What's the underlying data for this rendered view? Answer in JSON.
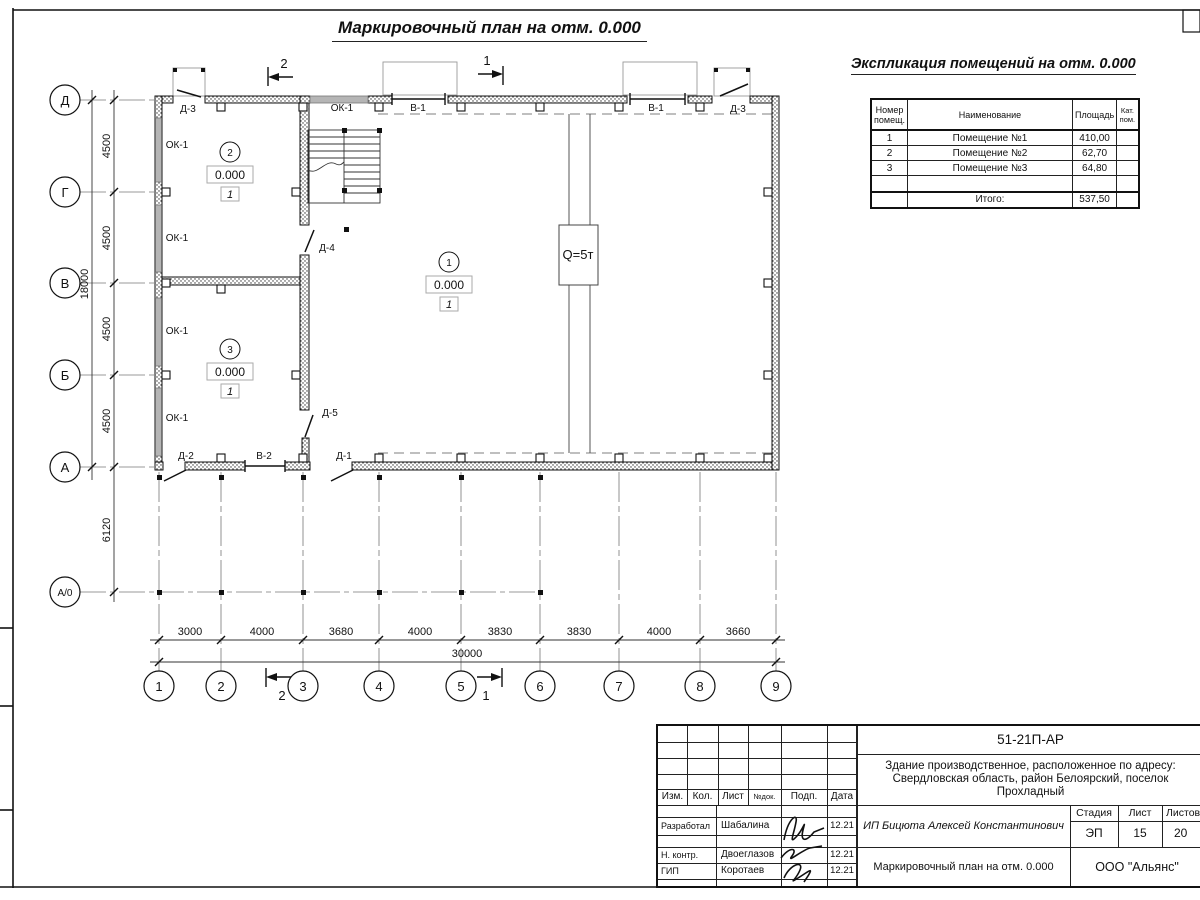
{
  "title": "Маркировочный план на отм. 0.000",
  "explication": {
    "title": "Экспликация помещений на отм. 0.000",
    "headers": [
      "Номер помещ.",
      "Наименование",
      "Площадь",
      "Кат. пом."
    ],
    "rows": [
      {
        "num": "1",
        "name": "Помещение №1",
        "area": "410,00",
        "cat": ""
      },
      {
        "num": "2",
        "name": "Помещение №2",
        "area": "62,70",
        "cat": ""
      },
      {
        "num": "3",
        "name": "Помещение №3",
        "area": "64,80",
        "cat": ""
      }
    ],
    "total_label": "Итого:",
    "total_value": "537,50"
  },
  "plan": {
    "axes_left": [
      "Д",
      "Г",
      "В",
      "Б",
      "А",
      "А/0"
    ],
    "axes_bottom": [
      "1",
      "2",
      "3",
      "4",
      "5",
      "6",
      "7",
      "8",
      "9"
    ],
    "dims_left": [
      "4500",
      "4500",
      "4500",
      "4500"
    ],
    "dim_left_total": "18000",
    "dim_offset_a0": "6120",
    "dims_bottom": [
      "3000",
      "4000",
      "3680",
      "4000",
      "3830",
      "3830",
      "4000",
      "3660"
    ],
    "dim_bottom_total": "30000",
    "section_1": "1",
    "section_2": "2",
    "crane_label": "Q=5т",
    "rooms": [
      {
        "no": "1",
        "elevation": "0.000",
        "floor_type": "1"
      },
      {
        "no": "2",
        "elevation": "0.000",
        "floor_type": "1"
      },
      {
        "no": "3",
        "elevation": "0.000",
        "floor_type": "1"
      }
    ],
    "marks": {
      "window": "ОК-1",
      "gate": "В-1",
      "gate2": "В-2",
      "door1": "Д-1",
      "door2": "Д-2",
      "door3": "Д-3",
      "door4": "Д-4",
      "door5": "Д-5"
    }
  },
  "stamp": {
    "doc_number": "51-21П-АР",
    "object_desc": "Здание производственное, расположенное по адресу: Свердловская область, район Белоярский, поселок Прохладный",
    "cols": [
      "Изм.",
      "Кол.",
      "Лист",
      "№док.",
      "Подп.",
      "Дата"
    ],
    "signers": [
      {
        "role": "Разработал",
        "name": "Шабалина",
        "date": "12.21"
      },
      {
        "role": "Н. контр.",
        "name": "Двоеглазов",
        "date": "12.21"
      },
      {
        "role": "ГИП",
        "name": "Коротаев",
        "date": "12.21"
      }
    ],
    "client": "ИП Бицюта Алексей Константинович",
    "stage_label": "Стадия",
    "sheet_label": "Лист",
    "sheets_label": "Листов",
    "stage": "ЭП",
    "sheet_num": "15",
    "sheets_total": "20",
    "sheet_title": "Маркировочный план на отм. 0.000",
    "company": "ООО \"Альянс\""
  }
}
